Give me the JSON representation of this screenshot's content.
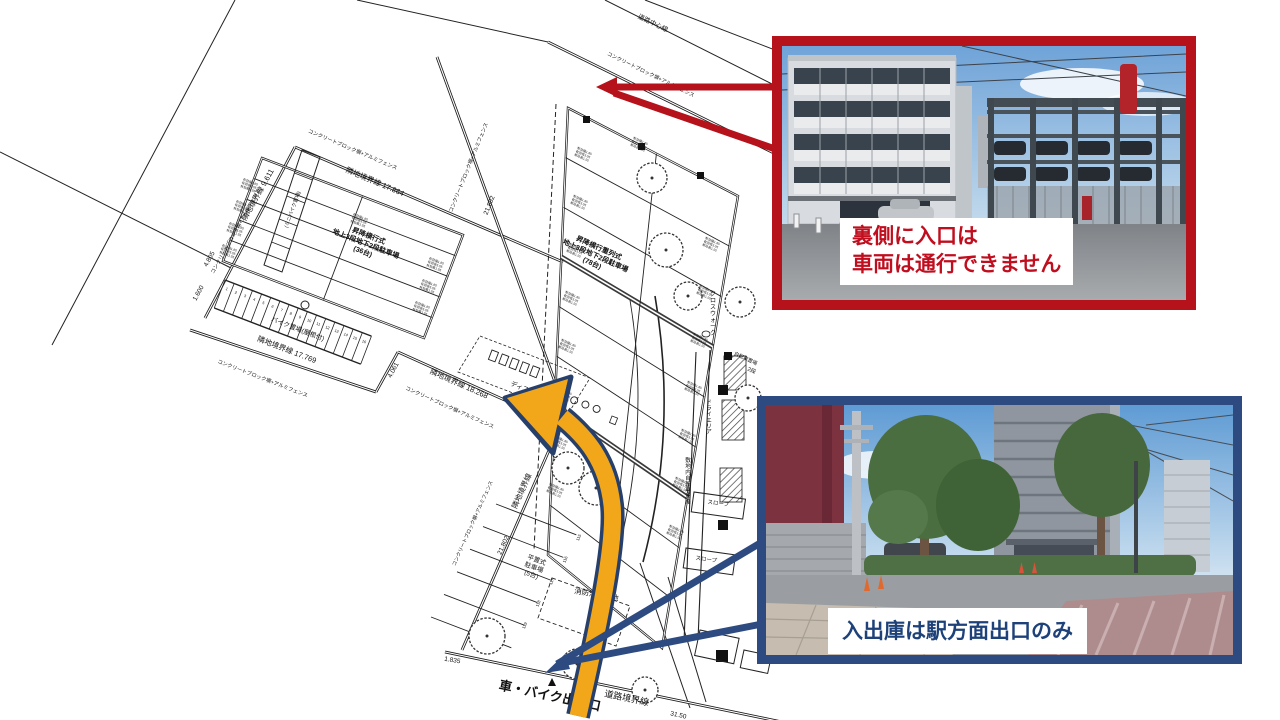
{
  "callouts": {
    "rear": {
      "line1": "裏側に入口は",
      "line2": "車両は通行できません"
    },
    "front": {
      "text": "入出庫は駅方面出口のみ"
    }
  },
  "colors": {
    "callout_red": "#B5121B",
    "callout_red_text": "#C00E1E",
    "callout_blue": "#2D4B80",
    "callout_blue_text": "#1D4178",
    "arrow_fill": "#F2A71B",
    "arrow_outline": "#27406B"
  },
  "plan": {
    "micro_spec": [
      "有効幅1.85",
      "有効長5.05",
      "有効高1.55"
    ],
    "bike_stall_numbers": [
      "1",
      "2",
      "3",
      "4",
      "5",
      "6",
      "7",
      "8",
      "9",
      "10",
      "11",
      "12",
      "13",
      "14",
      "15",
      "16"
    ],
    "flat_stall_numbers": [
      "115",
      "116",
      "117",
      "118",
      "119"
    ],
    "labels": [
      {
        "t": "道路中心線",
        "x": 652,
        "y": 25,
        "r": 26,
        "s": 6.5
      },
      {
        "t": "コンクリートブロック塀+アルミフェンス",
        "x": 650,
        "y": 76,
        "r": 26,
        "s": 5.2
      },
      {
        "t": "コンクリートブロック塀+アルミフェンス",
        "x": 352,
        "y": 151,
        "r": 23,
        "s": 5.2
      },
      {
        "t": "隣地境界線 17.864",
        "x": 374,
        "y": 184,
        "r": 23,
        "s": 7.5
      },
      {
        "t": "隣地境界線 9.611",
        "x": 260,
        "y": 196,
        "r": -61,
        "s": 7.5
      },
      {
        "t": "コンクリートブロック塀+アルミフェンス",
        "x": 237,
        "y": 232,
        "r": -61,
        "s": 5.2
      },
      {
        "t": "4.805",
        "x": 211,
        "y": 260,
        "r": -61,
        "s": 6.5
      },
      {
        "t": "1.600",
        "x": 200,
        "y": 294,
        "r": -61,
        "s": 6.5
      },
      {
        "t": "隣地境界線 17.769",
        "x": 286,
        "y": 352,
        "r": 21,
        "s": 7.5
      },
      {
        "t": "コンクリートブロック塀+アルミフェンス",
        "x": 262,
        "y": 380,
        "r": 21,
        "s": 5.2
      },
      {
        "t": "4.061",
        "x": 395,
        "y": 371,
        "r": -62,
        "s": 6.5
      },
      {
        "t": "隣地境界線 18.268",
        "x": 458,
        "y": 386,
        "r": 24,
        "s": 7.5
      },
      {
        "t": "コンクリートブロック塀+アルミフェンス",
        "x": 449,
        "y": 409,
        "r": 24,
        "s": 5.2
      },
      {
        "t": "コンクリートブロック塀+アルミフェンス",
        "x": 470,
        "y": 168,
        "r": -68,
        "s": 5.2
      },
      {
        "t": "21.802",
        "x": 491,
        "y": 206,
        "r": -68,
        "s": 6.5
      },
      {
        "t": "隣地境界線",
        "x": 524,
        "y": 492,
        "r": -66,
        "s": 7.5
      },
      {
        "t": "21.802",
        "x": 505,
        "y": 546,
        "r": -66,
        "s": 6.5
      },
      {
        "t": "コンクリートブロック塀+アルミフェンス",
        "x": 474,
        "y": 524,
        "r": -66,
        "s": 5
      },
      {
        "t": "1.835",
        "x": 452,
        "y": 662,
        "r": 10,
        "s": 6.5
      },
      {
        "t": "車・バイク出入口",
        "x": 549,
        "y": 700,
        "r": 12,
        "s": 13,
        "b": true
      },
      {
        "t": "道路境界線",
        "x": 626,
        "y": 701,
        "r": 12,
        "s": 9
      },
      {
        "t": "31.50",
        "x": 678,
        "y": 717,
        "r": 12,
        "s": 6.5
      },
      {
        "t": "消防活動空地",
        "x": 596,
        "y": 597,
        "r": 10,
        "s": 7.5
      },
      {
        "t": "ディスポ",
        "x": 522,
        "y": 390,
        "r": 21,
        "s": 6.5
      },
      {
        "t": "ドライエリア",
        "x": 709,
        "y": 404,
        "v": true,
        "s": 5.5
      },
      {
        "t": "スロープ",
        "x": 718,
        "y": 505,
        "r": 8,
        "s": 5.5
      },
      {
        "t": "スロープ",
        "x": 706,
        "y": 561,
        "r": 8,
        "s": 5.5
      },
      {
        "t": "クロスウォーク",
        "x": 713,
        "y": 296,
        "v": true,
        "s": 6
      },
      {
        "t": "敷地内自転車通路",
        "x": 688,
        "y": 462,
        "v": true,
        "s": 5.5
      },
      {
        "t": "自転車置場",
        "x": 745,
        "y": 360,
        "r": 25,
        "s": 5
      },
      {
        "t": "2段",
        "x": 751,
        "y": 372,
        "r": 25,
        "s": 5.5
      },
      {
        "t": "バイク置場(屋根付)",
        "x": 297,
        "y": 331,
        "r": 21,
        "s": 6.5
      },
      {
        "t": "(ミニバイク置場)",
        "x": 294,
        "y": 210,
        "r": -70,
        "s": 5
      },
      {
        "lines": [
          "昇降横行式",
          "地上3段地下2段駐車場",
          "(36台)"
        ],
        "x": 368,
        "y": 238,
        "r": 21,
        "s": 7,
        "b": true
      },
      {
        "lines": [
          "昇降横行重列式",
          "地上3段地下2段駐車場",
          "(78台)"
        ],
        "x": 598,
        "y": 250,
        "r": 24,
        "s": 7,
        "b": true
      },
      {
        "lines": [
          "平置式",
          "駐車場",
          "(5台)"
        ],
        "x": 536,
        "y": 562,
        "r": 20,
        "s": 6.5
      }
    ]
  }
}
